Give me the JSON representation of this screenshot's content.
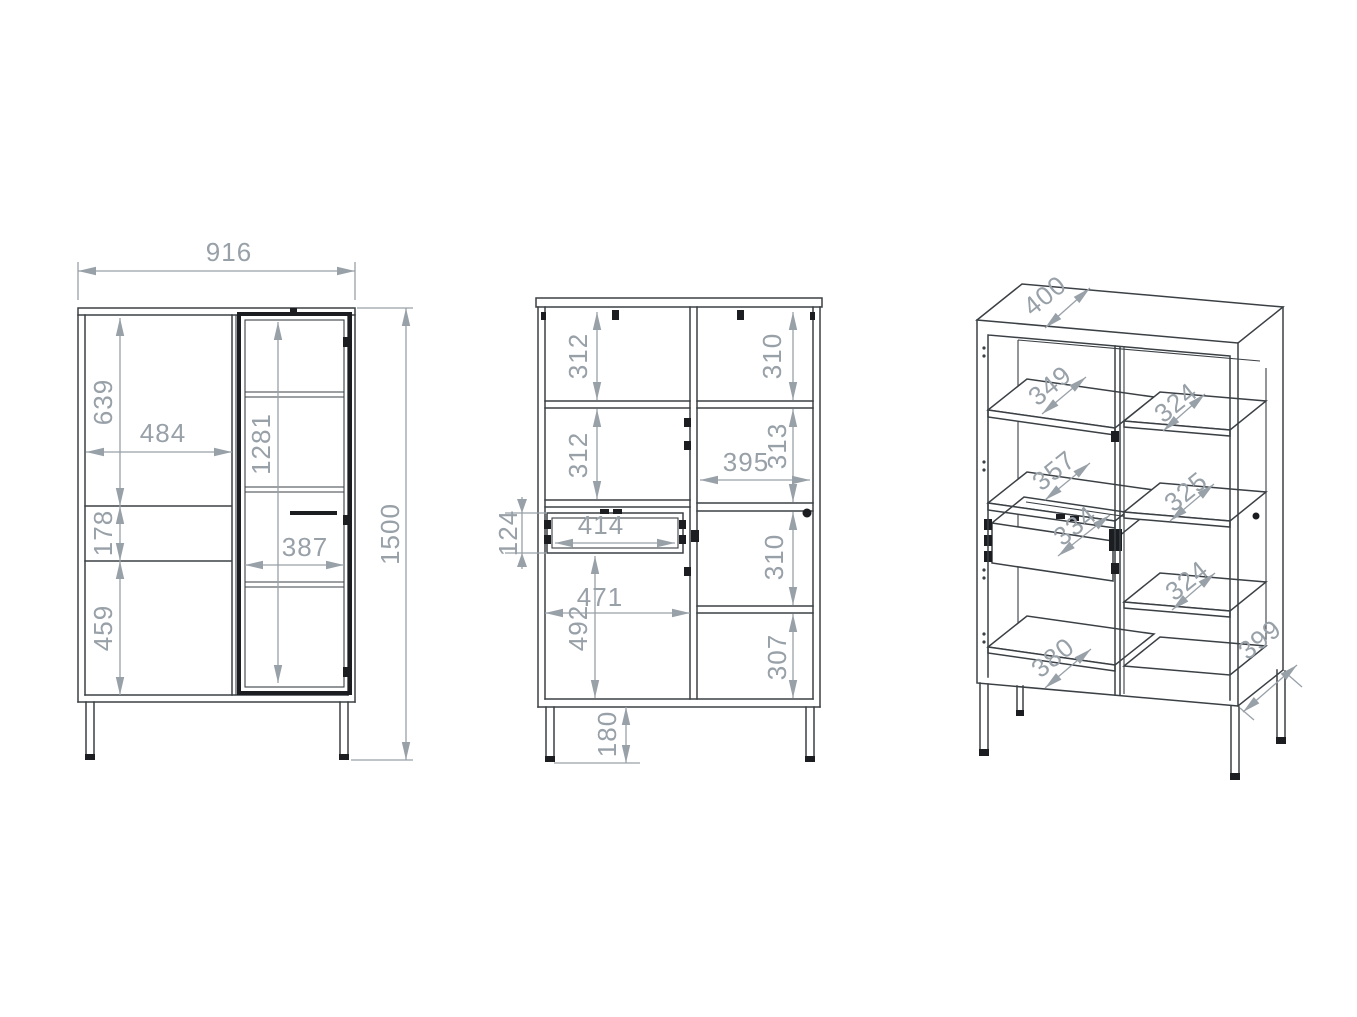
{
  "drawing": {
    "type": "furniture-technical-drawing",
    "units": "mm",
    "colors": {
      "structure_line": "#3b4045",
      "dark_accent": "#1b1d20",
      "dimension": "#98a0a8",
      "background": "#ffffff"
    }
  },
  "views": {
    "front": {
      "name": "front-elevation",
      "dims": {
        "width": "916",
        "height": "1500",
        "door_top": "639",
        "door_width": "484",
        "glass_height": "1281",
        "drawer_front": "178",
        "door_bottom": "459",
        "glass_width": "387"
      }
    },
    "internal": {
      "name": "internal-front",
      "dims": {
        "left_top": "312",
        "left_mid": "312",
        "drawer_h": "124",
        "drawer_w": "414",
        "left_w": "471",
        "left_bottom": "492",
        "leg": "180",
        "right_top": "310",
        "right_upper": "313",
        "right_w": "395",
        "right_mid": "310",
        "right_bottom": "307"
      }
    },
    "perspective": {
      "name": "perspective-open",
      "dims": {
        "top_depth": "400",
        "left_shelf_1": "349",
        "left_shelf_2": "357",
        "drawer_depth": "334",
        "bottom_depth": "380",
        "right_shelf_1": "324",
        "right_shelf_2": "325",
        "right_shelf_3": "324",
        "side_depth": "399"
      }
    }
  }
}
